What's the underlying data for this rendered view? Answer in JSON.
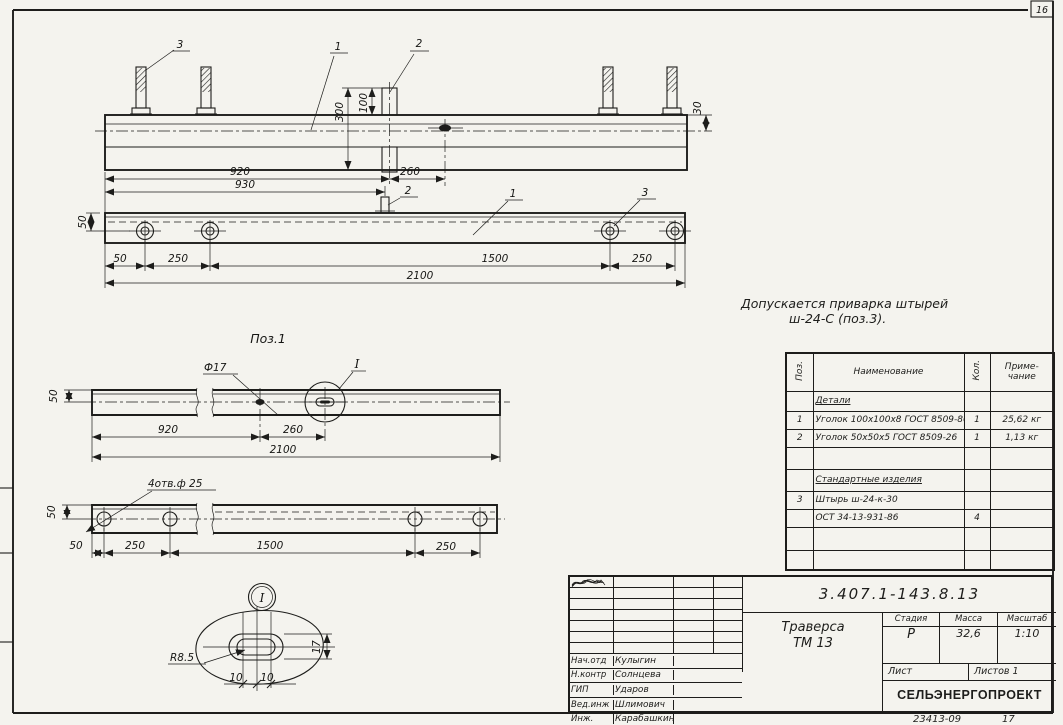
{
  "page": {
    "corner_number": "16",
    "footer_doc_number": "23413-09",
    "footer_sheet": "17"
  },
  "note": {
    "line1": "Допускается приварка штырей",
    "line2": "ш-24-С (поз.3)."
  },
  "drawing": {
    "elevation": {
      "callout_pin": "3",
      "callout_beam": "1",
      "callout_plate": "2",
      "dim_300": "300",
      "dim_100": "100",
      "dim_30": "30",
      "dim_920": "920",
      "dim_260": "260"
    },
    "plan": {
      "callout_plate": "2",
      "callout_beam": "1",
      "callout_pin": "3",
      "dim_930": "930",
      "dim_50_vert": "50",
      "dim_50": "50",
      "dim_250_left": "250",
      "dim_1500": "1500",
      "dim_250_right": "250",
      "dim_2100": "2100"
    },
    "pos1": {
      "title": "Поз.1",
      "hole_label": "Ф17",
      "detail_ref": "I",
      "dim_50_vert": "50",
      "dim_920": "920",
      "dim_260": "260",
      "dim_2100": "2100"
    },
    "holes": {
      "label": "4отв.ф 25",
      "dim_50_vert": "50",
      "dim_50": "50",
      "dim_250_left": "250",
      "dim_1500": "1500",
      "dim_250_right": "250"
    },
    "detail": {
      "ref": "I",
      "radius": "R8.5",
      "dim_17": "17",
      "dim_10_left": "10",
      "dim_10_right": "10"
    }
  },
  "parts_table": {
    "headers": {
      "pos": "Поз.",
      "name": "Наименование",
      "qty": "Кол.",
      "note1": "Приме-",
      "note2": "чание"
    },
    "section_details": "Детали",
    "section_standard": "Стандартные изделия",
    "rows": [
      {
        "pos": "1",
        "name": "Уголок 100x100x8 ГОСТ 8509-86",
        "qty": "1",
        "note": "25,62 кг"
      },
      {
        "pos": "2",
        "name": "Уголок 50x50x5 ГОСТ 8509-26",
        "qty": "1",
        "note": "1,13 кг"
      },
      {
        "pos": "3",
        "name": "Штырь ш-24-к-30",
        "qty": "",
        "note": ""
      },
      {
        "pos": "",
        "name": "ОСТ 34-13-931-86",
        "qty": "4",
        "note": ""
      }
    ]
  },
  "title_block": {
    "doc_number": "3.407.1-143.8.13",
    "title_line1": "Траверса",
    "title_line2": "ТМ 13",
    "stage_label": "Стадия",
    "mass_label": "Масса",
    "scale_label": "Масштаб",
    "stage": "Р",
    "mass": "32,6",
    "scale": "1:10",
    "sheet_label": "Лист",
    "sheets_label": "Листов 1",
    "organization": "СЕЛЬЭНЕРГОПРОЕКТ",
    "signatures": [
      {
        "role": "Нач.отд",
        "name": "Кулыгин"
      },
      {
        "role": "Н.контр",
        "name": "Солнцева"
      },
      {
        "role": "ГИП",
        "name": "Ударов"
      },
      {
        "role": "Вед.инж",
        "name": "Шлимович"
      },
      {
        "role": "Инж.",
        "name": "Карабашкин"
      }
    ]
  }
}
